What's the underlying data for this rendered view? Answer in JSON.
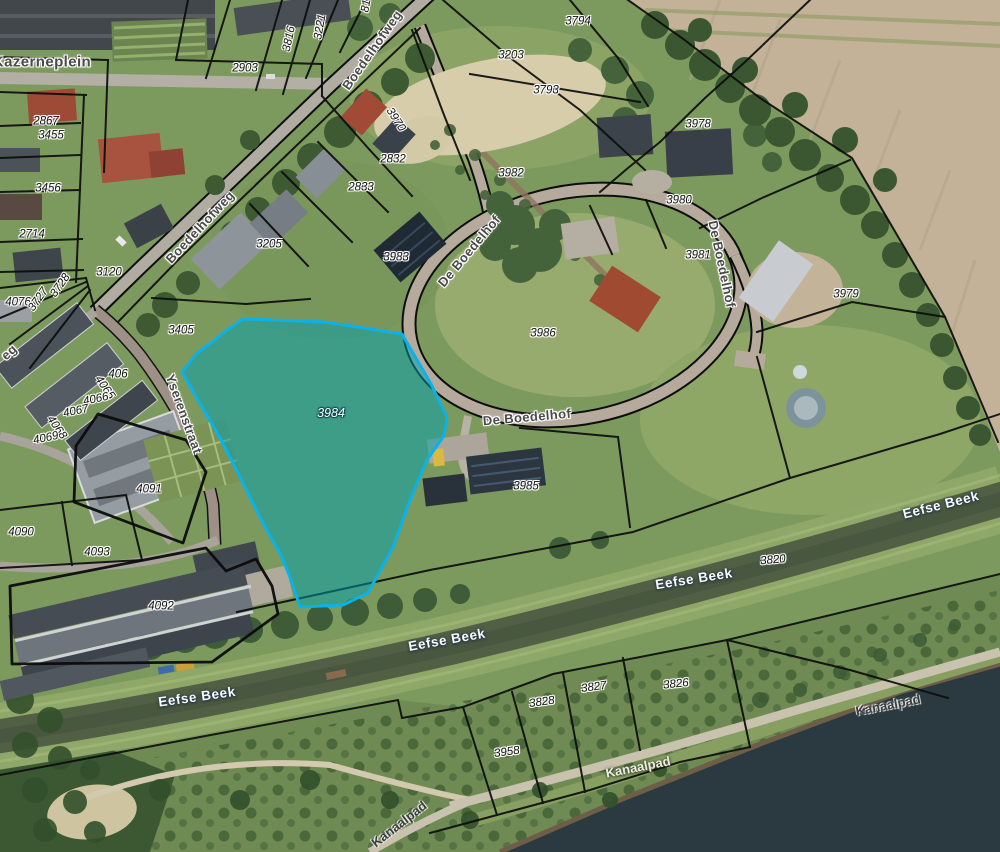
{
  "map": {
    "title": "Cadastral aerial map with highlighted parcel",
    "highlight": {
      "parcel_id": "3984",
      "border_color": "#0ab2e8",
      "fill_color": "rgba(0,160,176,0.5)"
    },
    "street_names": [
      "Kazerneplein",
      "Boedelhofweg",
      "De Boedelhof",
      "Yserenstraat",
      "Eefse Beek",
      "Kanaalpad"
    ],
    "parcel_numbers": [
      "81",
      "2714",
      "2832",
      "2833",
      "2867",
      "2903",
      "3120",
      "3203",
      "3205",
      "3221",
      "3405",
      "3455",
      "3456",
      "3727",
      "3728",
      "3793",
      "3794",
      "3816",
      "3820",
      "3826",
      "3827",
      "3828",
      "3958",
      "3970",
      "3978",
      "3979",
      "3980",
      "3981",
      "3982",
      "3983",
      "3984",
      "3985",
      "3986",
      "406",
      "4065",
      "4066",
      "4067",
      "4068",
      "4069",
      "4076",
      "4090",
      "4091",
      "4092",
      "4093"
    ]
  },
  "labels": [
    {
      "t": "Kazerneplein",
      "x": 42,
      "y": 62,
      "r": 0,
      "c": "street street-big"
    },
    {
      "t": "Boedelhofweg",
      "x": 372,
      "y": 50,
      "r": -55,
      "c": "street"
    },
    {
      "t": "Boedelhofweg",
      "x": 200,
      "y": 227,
      "r": -47,
      "c": "street"
    },
    {
      "t": "De Boedelhof",
      "x": 469,
      "y": 251,
      "r": -50,
      "c": "street"
    },
    {
      "t": "De Boedelhof",
      "x": 527,
      "y": 417,
      "r": -5,
      "c": "street"
    },
    {
      "t": "De Boedelhof",
      "x": 722,
      "y": 264,
      "r": 78,
      "c": "street"
    },
    {
      "t": "Yserenstraat",
      "x": 184,
      "y": 414,
      "r": 70,
      "c": "street"
    },
    {
      "t": "eg",
      "x": 9,
      "y": 352,
      "r": -42,
      "c": "street"
    },
    {
      "t": "Eefse Beek",
      "x": 941,
      "y": 505,
      "r": -14,
      "c": "water"
    },
    {
      "t": "Eefse Beek",
      "x": 694,
      "y": 579,
      "r": -9,
      "c": "water"
    },
    {
      "t": "Eefse Beek",
      "x": 447,
      "y": 640,
      "r": -10,
      "c": "water"
    },
    {
      "t": "Eefse Beek",
      "x": 197,
      "y": 697,
      "r": -8,
      "c": "water"
    },
    {
      "t": "Kanaalpad",
      "x": 638,
      "y": 767,
      "r": -11,
      "c": "path-light"
    },
    {
      "t": "Kanaalpad",
      "x": 888,
      "y": 705,
      "r": -11,
      "c": "path-dark"
    },
    {
      "t": "Kanaalpad",
      "x": 399,
      "y": 824,
      "r": -38,
      "c": "path-dark"
    },
    {
      "t": "2903",
      "x": 245,
      "y": 69,
      "r": 0,
      "c": "parcel"
    },
    {
      "t": "3816",
      "x": 290,
      "y": 39,
      "r": -78,
      "c": "parcel"
    },
    {
      "t": "3221",
      "x": 321,
      "y": 27,
      "r": -80,
      "c": "parcel"
    },
    {
      "t": "81",
      "x": 367,
      "y": 6,
      "r": -80,
      "c": "parcel"
    },
    {
      "t": "3794",
      "x": 578,
      "y": 22,
      "r": 0,
      "c": "parcel"
    },
    {
      "t": "3203",
      "x": 511,
      "y": 56,
      "r": 0,
      "c": "parcel"
    },
    {
      "t": "3793",
      "x": 546,
      "y": 91,
      "r": 0,
      "c": "parcel"
    },
    {
      "t": "3970",
      "x": 395,
      "y": 120,
      "r": 57,
      "c": "parcel"
    },
    {
      "t": "2832",
      "x": 393,
      "y": 160,
      "r": 0,
      "c": "parcel"
    },
    {
      "t": "2833",
      "x": 361,
      "y": 188,
      "r": 0,
      "c": "parcel"
    },
    {
      "t": "3982",
      "x": 511,
      "y": 174,
      "r": 0,
      "c": "parcel"
    },
    {
      "t": "3983",
      "x": 396,
      "y": 258,
      "r": 0,
      "c": "parcel"
    },
    {
      "t": "3205",
      "x": 269,
      "y": 245,
      "r": 0,
      "c": "parcel"
    },
    {
      "t": "3978",
      "x": 698,
      "y": 125,
      "r": 0,
      "c": "parcel"
    },
    {
      "t": "3980",
      "x": 679,
      "y": 201,
      "r": 0,
      "c": "parcel"
    },
    {
      "t": "3981",
      "x": 698,
      "y": 256,
      "r": 0,
      "c": "parcel"
    },
    {
      "t": "3979",
      "x": 846,
      "y": 295,
      "r": 0,
      "c": "parcel"
    },
    {
      "t": "3986",
      "x": 543,
      "y": 334,
      "r": 0,
      "c": "parcel"
    },
    {
      "t": "2867",
      "x": 46,
      "y": 122,
      "r": 0,
      "c": "parcel"
    },
    {
      "t": "3455",
      "x": 51,
      "y": 136,
      "r": 0,
      "c": "parcel"
    },
    {
      "t": "3456",
      "x": 48,
      "y": 189,
      "r": 0,
      "c": "parcel"
    },
    {
      "t": "2714",
      "x": 32,
      "y": 235,
      "r": 0,
      "c": "parcel"
    },
    {
      "t": "3120",
      "x": 109,
      "y": 273,
      "r": 0,
      "c": "parcel"
    },
    {
      "t": "4076",
      "x": 18,
      "y": 303,
      "r": 0,
      "c": "parcel"
    },
    {
      "t": "3727",
      "x": 39,
      "y": 300,
      "r": -55,
      "c": "parcel"
    },
    {
      "t": "3728",
      "x": 61,
      "y": 286,
      "r": -55,
      "c": "parcel"
    },
    {
      "t": "3405",
      "x": 181,
      "y": 331,
      "r": 0,
      "c": "parcel"
    },
    {
      "t": "406",
      "x": 118,
      "y": 375,
      "r": 0,
      "c": "parcel"
    },
    {
      "t": "4065",
      "x": 104,
      "y": 388,
      "r": 55,
      "c": "parcel"
    },
    {
      "t": "4066",
      "x": 96,
      "y": 400,
      "r": -12,
      "c": "parcel"
    },
    {
      "t": "4067",
      "x": 76,
      "y": 412,
      "r": -12,
      "c": "parcel"
    },
    {
      "t": "4068",
      "x": 56,
      "y": 428,
      "r": 55,
      "c": "parcel"
    },
    {
      "t": "4069",
      "x": 46,
      "y": 439,
      "r": -12,
      "c": "parcel"
    },
    {
      "t": "4091",
      "x": 149,
      "y": 490,
      "r": 0,
      "c": "parcel"
    },
    {
      "t": "4090",
      "x": 21,
      "y": 533,
      "r": 0,
      "c": "parcel"
    },
    {
      "t": "4093",
      "x": 97,
      "y": 553,
      "r": 0,
      "c": "parcel"
    },
    {
      "t": "4092",
      "x": 161,
      "y": 607,
      "r": 0,
      "c": "parcel"
    },
    {
      "t": "3984",
      "x": 331,
      "y": 413,
      "r": 0,
      "c": "parcel-hl"
    },
    {
      "t": "3985",
      "x": 526,
      "y": 487,
      "r": 0,
      "c": "parcel"
    },
    {
      "t": "3820",
      "x": 773,
      "y": 561,
      "r": -5,
      "c": "parcel"
    },
    {
      "t": "3826",
      "x": 676,
      "y": 685,
      "r": -6,
      "c": "parcel"
    },
    {
      "t": "3827",
      "x": 594,
      "y": 688,
      "r": -8,
      "c": "parcel"
    },
    {
      "t": "3828",
      "x": 542,
      "y": 703,
      "r": -8,
      "c": "parcel"
    },
    {
      "t": "3958",
      "x": 507,
      "y": 753,
      "r": -8,
      "c": "parcel"
    }
  ]
}
